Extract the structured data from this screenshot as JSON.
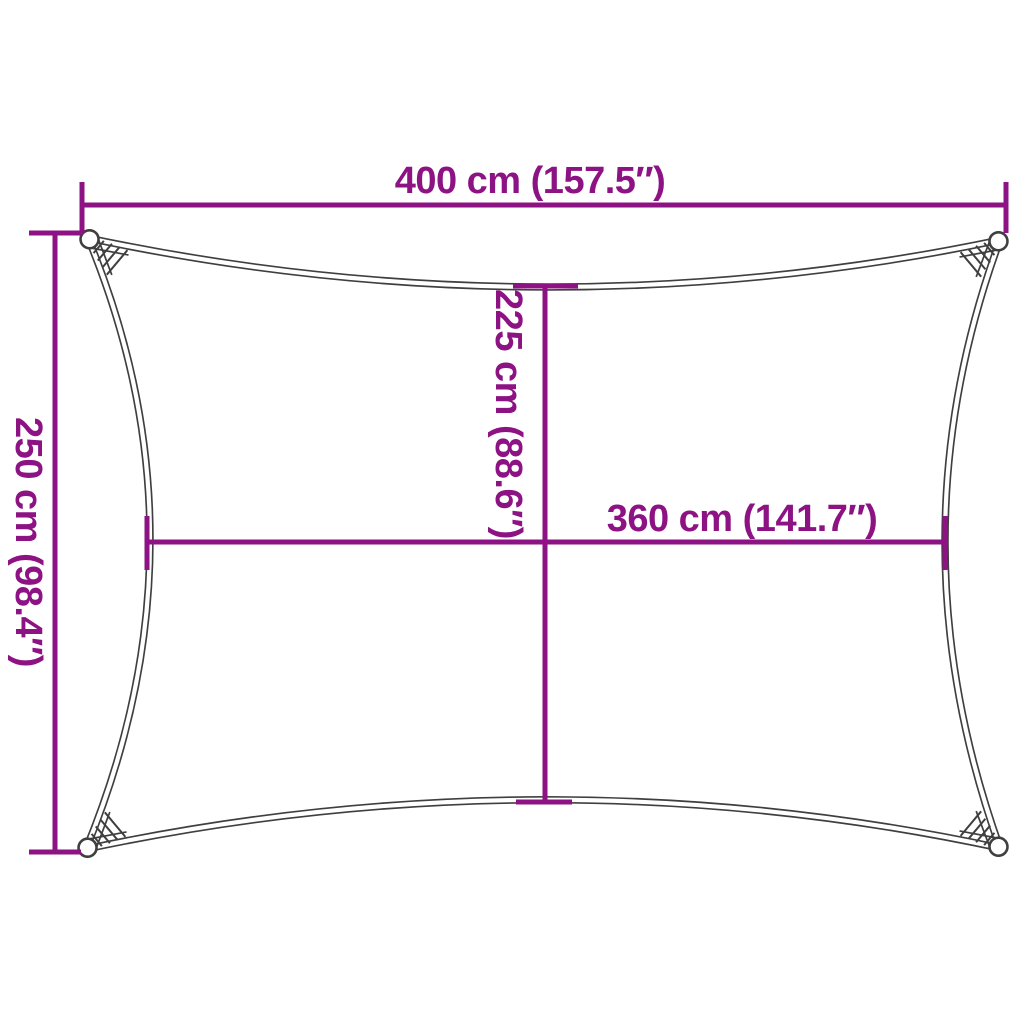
{
  "title": "Shade sail dimension diagram",
  "colors": {
    "dimension": "#8D1283",
    "outline": "#3F3F3F",
    "background": "#FFFFFF"
  },
  "dimensions": {
    "top": {
      "cm": 400,
      "inches": 157.5,
      "label": "400 cm (157.5″)"
    },
    "left": {
      "cm": 250,
      "inches": 98.4,
      "label": "250 cm (98.4″)"
    },
    "middle_vertical": {
      "cm": 225,
      "inches": 88.6,
      "label": "225 cm (88.6″)"
    },
    "middle_horizontal": {
      "cm": 360,
      "inches": 141.7,
      "label": "360 cm (141.7″)"
    }
  }
}
